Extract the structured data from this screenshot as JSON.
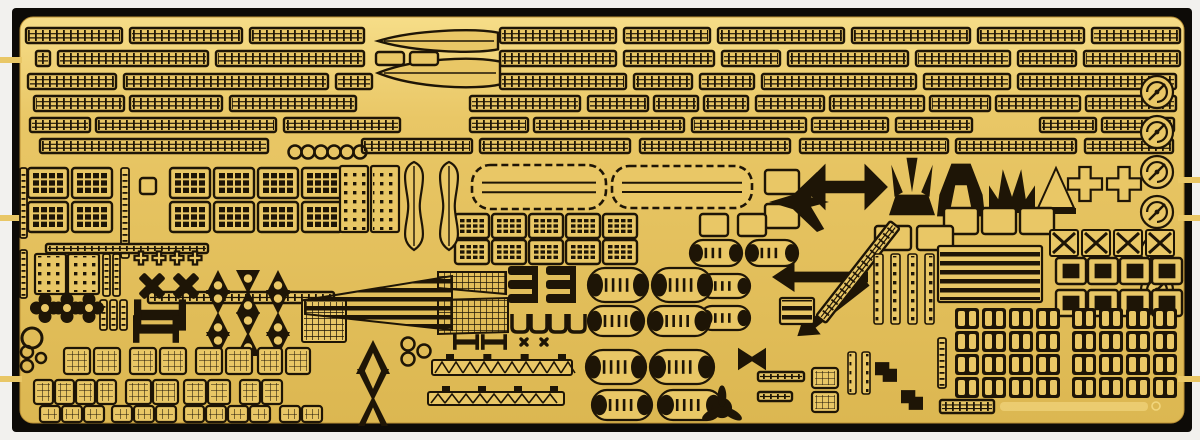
{
  "meta": {
    "alt": "Photograph of a gold photo-etched brass detail fret for a model ship kit, mounted on a black backing board, containing rows of railings, ladders, radar dishes, hatches, doors, life rafts, propeller guards and other small etched parts"
  },
  "colors": {
    "bg": "#f2f1ee",
    "backing": "#0d0b07",
    "brass": "#e9c766",
    "brass_hi": "#f6dd88",
    "brass_lo": "#dcb751",
    "etch": "#1e1506"
  },
  "frame": {
    "backing": {
      "x": 12,
      "y": 8,
      "w": 1180,
      "h": 424,
      "r": 4
    },
    "brass": {
      "x": 20,
      "y": 17,
      "w": 1164,
      "h": 406,
      "r": 13
    },
    "tabs": [
      {
        "x": 0,
        "y": 57,
        "w": 22,
        "h": 6
      },
      {
        "x": 0,
        "y": 215,
        "w": 22,
        "h": 6
      },
      {
        "x": 0,
        "y": 376,
        "w": 22,
        "h": 6
      },
      {
        "x": 1178,
        "y": 177,
        "w": 22,
        "h": 6
      },
      {
        "x": 1178,
        "y": 215,
        "w": 22,
        "h": 6
      },
      {
        "x": 1178,
        "y": 376,
        "w": 22,
        "h": 6
      }
    ],
    "faint_mark": {
      "x": 1000,
      "y": 402,
      "w": 148,
      "h": 9,
      "ring_x": 1156,
      "ring_y": 406
    }
  },
  "rail_rows": [
    {
      "y": 28,
      "h": 15,
      "segs": [
        [
          26,
          96
        ],
        [
          130,
          112
        ],
        [
          250,
          114
        ],
        [
          500,
          116
        ],
        [
          624,
          86
        ],
        [
          718,
          126
        ],
        [
          852,
          118
        ],
        [
          978,
          106
        ],
        [
          1092,
          88
        ]
      ]
    },
    {
      "y": 51,
      "h": 15,
      "segs": [
        [
          36,
          14
        ],
        [
          58,
          150
        ],
        [
          216,
          148
        ],
        [
          500,
          116
        ],
        [
          624,
          90
        ],
        [
          722,
          58
        ],
        [
          788,
          120
        ],
        [
          916,
          94
        ],
        [
          1018,
          58
        ],
        [
          1084,
          96
        ]
      ]
    },
    {
      "y": 74,
      "h": 15,
      "segs": [
        [
          28,
          88
        ],
        [
          124,
          204
        ],
        [
          336,
          36
        ],
        [
          500,
          126
        ],
        [
          634,
          58
        ],
        [
          700,
          54
        ],
        [
          762,
          154
        ],
        [
          924,
          86
        ],
        [
          1018,
          158
        ]
      ]
    },
    {
      "y": 96,
      "h": 15,
      "segs": [
        [
          34,
          90
        ],
        [
          130,
          92
        ],
        [
          230,
          126
        ],
        [
          470,
          110
        ],
        [
          588,
          60
        ],
        [
          654,
          44
        ],
        [
          704,
          44
        ],
        [
          756,
          68
        ],
        [
          830,
          94
        ],
        [
          930,
          60
        ],
        [
          996,
          84
        ],
        [
          1086,
          90
        ]
      ]
    },
    {
      "y": 118,
      "h": 14,
      "segs": [
        [
          30,
          60
        ],
        [
          96,
          180
        ],
        [
          284,
          116
        ],
        [
          470,
          58
        ],
        [
          534,
          150
        ],
        [
          692,
          114
        ],
        [
          812,
          76
        ],
        [
          896,
          76
        ],
        [
          1040,
          56
        ],
        [
          1102,
          72
        ]
      ]
    },
    {
      "y": 139,
      "h": 14,
      "segs": [
        [
          40,
          228
        ],
        [
          362,
          110
        ],
        [
          480,
          150
        ],
        [
          640,
          150
        ],
        [
          800,
          148
        ],
        [
          956,
          120
        ],
        [
          1085,
          88
        ]
      ]
    }
  ],
  "parts": [
    {
      "t": "spearH",
      "x": 378,
      "y": 30,
      "w": 120,
      "h": 22
    },
    {
      "t": "spearH",
      "x": 378,
      "y": 58,
      "w": 122,
      "h": 30
    },
    {
      "t": "frame",
      "x": 376,
      "y": 52,
      "w": 28,
      "h": 13
    },
    {
      "t": "frame",
      "x": 410,
      "y": 52,
      "w": 28,
      "h": 13
    },
    {
      "t": "ring",
      "cx": 295,
      "cy": 152,
      "r": 6.5,
      "sw": 2.5,
      "grid": {
        "nx": 6,
        "dx": 13
      }
    },
    {
      "t": "doorblock",
      "x": 28,
      "y": 168,
      "w": 40,
      "h": 30,
      "grid": {
        "nx": 2,
        "dx": 44,
        "ny": 2,
        "dy": 34
      }
    },
    {
      "t": "doorblock",
      "x": 170,
      "y": 168,
      "w": 40,
      "h": 30,
      "grid": {
        "nx": 4,
        "dx": 44,
        "ny": 2,
        "dy": 34
      }
    },
    {
      "t": "doorblock",
      "x": 455,
      "y": 214,
      "w": 34,
      "h": 24,
      "grid": {
        "nx": 5,
        "dx": 37,
        "ny": 2,
        "dy": 26
      }
    },
    {
      "t": "vlad",
      "x": 121,
      "y": 168,
      "w": 8,
      "h": 90
    },
    {
      "t": "vlad",
      "x": 20,
      "y": 168,
      "w": 7,
      "h": 70
    },
    {
      "t": "vlad",
      "x": 20,
      "y": 250,
      "w": 7,
      "h": 48
    },
    {
      "t": "vlad",
      "x": 103,
      "y": 254,
      "w": 7,
      "h": 42,
      "grid": {
        "nx": 2,
        "dx": 10
      }
    },
    {
      "t": "vlad",
      "x": 100,
      "y": 300,
      "w": 7,
      "h": 30,
      "grid": {
        "nx": 3,
        "dx": 10
      }
    },
    {
      "t": "frame",
      "x": 140,
      "y": 178,
      "w": 16,
      "h": 16
    },
    {
      "t": "dotp",
      "x": 340,
      "y": 166,
      "w": 28,
      "h": 66
    },
    {
      "t": "dotp",
      "x": 371,
      "y": 166,
      "w": 28,
      "h": 66
    },
    {
      "t": "dotp",
      "x": 35,
      "y": 254,
      "w": 31,
      "h": 40
    },
    {
      "t": "dotp",
      "x": 68,
      "y": 254,
      "w": 31,
      "h": 40
    },
    {
      "t": "bottle",
      "x": 398,
      "y": 162,
      "w": 32,
      "h": 88
    },
    {
      "t": "bottle",
      "x": 433,
      "y": 162,
      "w": 32,
      "h": 88
    },
    {
      "t": "deckp",
      "x": 472,
      "y": 165,
      "w": 134,
      "h": 44
    },
    {
      "t": "deckp",
      "x": 612,
      "y": 166,
      "w": 140,
      "h": 42
    },
    {
      "t": "frame",
      "x": 765,
      "y": 170,
      "w": 34,
      "h": 24
    },
    {
      "t": "frame",
      "x": 765,
      "y": 204,
      "w": 34,
      "h": 24
    },
    {
      "t": "organic",
      "v": "plane",
      "cx": 799,
      "cy": 202,
      "s": 60
    },
    {
      "t": "organic",
      "v": "anchor",
      "cx": 845,
      "cy": 187,
      "s": 78
    },
    {
      "t": "organic",
      "v": "tulip",
      "cx": 912,
      "cy": 190,
      "s": 46
    },
    {
      "t": "organic",
      "v": "bell",
      "cx": 961,
      "cy": 190,
      "s": 48
    },
    {
      "t": "organic",
      "v": "crown",
      "cx": 1012,
      "cy": 190,
      "s": 46
    },
    {
      "t": "organic",
      "v": "cone",
      "cx": 1056,
      "cy": 190,
      "s": 40
    },
    {
      "t": "plus",
      "cx": 1085,
      "cy": 184,
      "s": 34
    },
    {
      "t": "plus",
      "cx": 1124,
      "cy": 184,
      "s": 34
    },
    {
      "t": "radar",
      "cx": 1157,
      "cy": 92,
      "r": 16
    },
    {
      "t": "radar",
      "cx": 1157,
      "cy": 132,
      "r": 16
    },
    {
      "t": "radar",
      "cx": 1157,
      "cy": 172,
      "r": 16
    },
    {
      "t": "radar",
      "cx": 1157,
      "cy": 212,
      "r": 16
    },
    {
      "t": "radar",
      "cx": 1157,
      "cy": 252,
      "r": 16
    },
    {
      "t": "radar",
      "cx": 1157,
      "cy": 290,
      "r": 16
    },
    {
      "t": "frame",
      "x": 700,
      "y": 214,
      "w": 28,
      "h": 22,
      "grid": {
        "nx": 2,
        "dx": 38
      }
    },
    {
      "t": "frame",
      "x": 944,
      "y": 208,
      "w": 34,
      "h": 26,
      "grid": {
        "nx": 3,
        "dx": 38
      }
    },
    {
      "t": "frame",
      "x": 875,
      "y": 226,
      "w": 36,
      "h": 24,
      "grid": {
        "nx": 2,
        "dx": 42
      }
    },
    {
      "t": "xframe",
      "x": 1050,
      "y": 230,
      "w": 28,
      "h": 26,
      "grid": {
        "nx": 4,
        "dx": 32
      }
    },
    {
      "t": "frame",
      "x": 1056,
      "y": 258,
      "w": 30,
      "h": 26,
      "dark": true,
      "grid": {
        "nx": 4,
        "dx": 32,
        "ny": 2,
        "dy": 32
      }
    },
    {
      "t": "rail",
      "x": 46,
      "y": 244,
      "w": 162,
      "h": 9
    },
    {
      "t": "rail",
      "x": 148,
      "y": 292,
      "w": 186,
      "h": 11
    },
    {
      "t": "plus",
      "cx": 141,
      "cy": 258,
      "s": 13,
      "grid": {
        "nx": 4,
        "dx": 18
      }
    },
    {
      "t": "xcross",
      "cx": 152,
      "cy": 286,
      "s": 30
    },
    {
      "t": "xcross",
      "cx": 186,
      "cy": 286,
      "s": 30
    },
    {
      "t": "clover",
      "cx": 45,
      "cy": 308,
      "r": 9,
      "grid": {
        "nx": 3,
        "dx": 22
      }
    },
    {
      "t": "organic",
      "v": "dblT",
      "cx": 160,
      "cy": 315,
      "s": 52
    },
    {
      "t": "organic",
      "v": "dblT",
      "cx": 156,
      "cy": 329,
      "s": 46
    },
    {
      "t": "prop",
      "cx": 218,
      "cy": 282,
      "s": 24,
      "grid": {
        "nx": 3,
        "dx": 30,
        "ny": 2,
        "dy": 20
      }
    },
    {
      "t": "prop",
      "cx": 218,
      "cy": 324,
      "s": 24,
      "grid": {
        "nx": 3,
        "dx": 30,
        "ny": 2,
        "dy": 20
      }
    },
    {
      "t": "meshr",
      "x": 302,
      "y": 300,
      "w": 44,
      "h": 42
    },
    {
      "t": "poly",
      "fill": "stripes",
      "pts": [
        [
          305,
          300
        ],
        [
          452,
          276
        ],
        [
          452,
          330
        ],
        [
          305,
          314
        ]
      ]
    },
    {
      "t": "poly",
      "fill": "mesh",
      "pts": [
        [
          438,
          272
        ],
        [
          506,
          272
        ],
        [
          506,
          294
        ],
        [
          438,
          288
        ]
      ]
    },
    {
      "t": "poly",
      "fill": "mesh",
      "pts": [
        [
          438,
          300
        ],
        [
          508,
          298
        ],
        [
          508,
          332
        ],
        [
          438,
          334
        ]
      ]
    },
    {
      "t": "estack",
      "x": 508,
      "y": 266
    },
    {
      "t": "estack",
      "x": 546,
      "y": 266
    },
    {
      "t": "ucup",
      "x": 512,
      "y": 314,
      "w": 16,
      "h": 18,
      "grid": {
        "nx": 4,
        "dx": 19
      }
    },
    {
      "t": "float",
      "x": 690,
      "y": 240,
      "w": 52,
      "h": 26
    },
    {
      "t": "float",
      "x": 746,
      "y": 240,
      "w": 52,
      "h": 26
    },
    {
      "t": "float",
      "x": 700,
      "y": 274,
      "w": 50,
      "h": 24
    },
    {
      "t": "float",
      "x": 700,
      "y": 306,
      "w": 50,
      "h": 24
    },
    {
      "t": "float",
      "x": 588,
      "y": 268,
      "w": 60,
      "h": 34
    },
    {
      "t": "float",
      "x": 652,
      "y": 268,
      "w": 60,
      "h": 34
    },
    {
      "t": "float",
      "x": 588,
      "y": 306,
      "w": 56,
      "h": 30
    },
    {
      "t": "float",
      "x": 648,
      "y": 306,
      "w": 62,
      "h": 30
    },
    {
      "t": "float",
      "x": 586,
      "y": 350,
      "w": 60,
      "h": 34
    },
    {
      "t": "float",
      "x": 650,
      "y": 350,
      "w": 64,
      "h": 34
    },
    {
      "t": "float",
      "x": 592,
      "y": 390,
      "w": 60,
      "h": 30
    },
    {
      "t": "float",
      "x": 658,
      "y": 390,
      "w": 64,
      "h": 30
    },
    {
      "t": "arrowL",
      "x": 772,
      "y": 262,
      "w": 96,
      "h": 30
    },
    {
      "t": "arrowL",
      "x": 788,
      "y": 296,
      "w": 88,
      "h": 26,
      "angle": -38
    },
    {
      "t": "railrot",
      "x": 798,
      "y": 266,
      "w": 120,
      "h": 12,
      "angle": -52
    },
    {
      "t": "dstrip",
      "x": 874,
      "y": 254,
      "w": 9,
      "h": 70,
      "grid": {
        "nx": 4,
        "dx": 17
      }
    },
    {
      "t": "dstrip",
      "x": 848,
      "y": 352,
      "w": 8,
      "h": 42,
      "grid": {
        "nx": 2,
        "dx": 14
      }
    },
    {
      "t": "stripr",
      "x": 938,
      "y": 246,
      "w": 104,
      "h": 56
    },
    {
      "t": "stripr",
      "x": 780,
      "y": 298,
      "w": 34,
      "h": 26
    },
    {
      "t": "vlad",
      "x": 938,
      "y": 338,
      "w": 8,
      "h": 50
    },
    {
      "t": "pairdoor",
      "x": 955,
      "y": 308,
      "w": 24,
      "h": 21,
      "grid": {
        "nx": 4,
        "dx": 27,
        "ny": 4,
        "dy": 23
      }
    },
    {
      "t": "pairdoor",
      "x": 1072,
      "y": 308,
      "w": 24,
      "h": 21,
      "grid": {
        "nx": 4,
        "dx": 27,
        "ny": 4,
        "dy": 23
      }
    },
    {
      "t": "ring",
      "cx": 32,
      "cy": 338,
      "r": 10,
      "sw": 3
    },
    {
      "t": "ring",
      "cx": 27,
      "cy": 352,
      "r": 6,
      "sw": 2.5
    },
    {
      "t": "ring",
      "cx": 27,
      "cy": 366,
      "r": 6,
      "sw": 2.5
    },
    {
      "t": "ring",
      "cx": 41,
      "cy": 358,
      "r": 5,
      "sw": 2.5
    },
    {
      "t": "hatch",
      "x": 64,
      "y": 348,
      "w": 26,
      "h": 26,
      "grid": {
        "nx": 2,
        "dx": 30
      }
    },
    {
      "t": "hatch",
      "x": 130,
      "y": 348,
      "w": 26,
      "h": 26,
      "grid": {
        "nx": 2,
        "dx": 30
      }
    },
    {
      "t": "hatch",
      "x": 196,
      "y": 348,
      "w": 26,
      "h": 26,
      "grid": {
        "nx": 2,
        "dx": 30
      }
    },
    {
      "t": "hatch",
      "x": 258,
      "y": 348,
      "w": 24,
      "h": 26,
      "grid": {
        "nx": 2,
        "dx": 28
      }
    },
    {
      "t": "hatch",
      "x": 34,
      "y": 380,
      "w": 19,
      "h": 24,
      "grid": {
        "nx": 4,
        "dx": 21
      }
    },
    {
      "t": "hatch",
      "x": 126,
      "y": 380,
      "w": 25,
      "h": 24,
      "grid": {
        "nx": 2,
        "dx": 27
      }
    },
    {
      "t": "hatch",
      "x": 184,
      "y": 380,
      "w": 22,
      "h": 24,
      "grid": {
        "nx": 2,
        "dx": 24
      }
    },
    {
      "t": "hatch",
      "x": 240,
      "y": 380,
      "w": 20,
      "h": 24,
      "grid": {
        "nx": 2,
        "dx": 22
      }
    },
    {
      "t": "hatch",
      "x": 40,
      "y": 406,
      "w": 20,
      "h": 16,
      "grid": {
        "nx": 3,
        "dx": 22
      }
    },
    {
      "t": "hatch",
      "x": 112,
      "y": 406,
      "w": 20,
      "h": 16,
      "grid": {
        "nx": 3,
        "dx": 22
      }
    },
    {
      "t": "hatch",
      "x": 184,
      "y": 406,
      "w": 20,
      "h": 16,
      "grid": {
        "nx": 4,
        "dx": 22
      }
    },
    {
      "t": "hatch",
      "x": 280,
      "y": 406,
      "w": 20,
      "h": 16,
      "grid": {
        "nx": 2,
        "dx": 22
      }
    },
    {
      "t": "organic",
      "v": "chevUp",
      "cx": 373,
      "cy": 357,
      "s": 34
    },
    {
      "t": "organic",
      "v": "chevDown",
      "cx": 373,
      "cy": 385,
      "s": 32
    },
    {
      "t": "organic",
      "v": "chevUp",
      "cx": 373,
      "cy": 411,
      "s": 30
    },
    {
      "t": "ring",
      "cx": 408,
      "cy": 344,
      "r": 6.5,
      "sw": 2.5
    },
    {
      "t": "ring",
      "cx": 408,
      "cy": 359,
      "r": 6.5,
      "sw": 2.5
    },
    {
      "t": "ring",
      "cx": 424,
      "cy": 351,
      "r": 6.5,
      "sw": 2.5
    },
    {
      "t": "organic",
      "v": "dblT",
      "cx": 466,
      "cy": 342,
      "s": 26
    },
    {
      "t": "organic",
      "v": "dblT",
      "cx": 494,
      "cy": 342,
      "s": 26
    },
    {
      "t": "xcross",
      "cx": 524,
      "cy": 342,
      "s": 12
    },
    {
      "t": "xcross",
      "cx": 544,
      "cy": 342,
      "s": 12
    },
    {
      "t": "trussbar",
      "x": 432,
      "y": 360,
      "w": 140,
      "h": 15
    },
    {
      "t": "trussbar",
      "x": 428,
      "y": 392,
      "w": 136,
      "h": 13
    },
    {
      "t": "organic",
      "v": "bowtie",
      "cx": 752,
      "cy": 359,
      "s": 28
    },
    {
      "t": "organic",
      "v": "darkprop",
      "cx": 722,
      "cy": 408,
      "s": 36
    },
    {
      "t": "rail",
      "x": 758,
      "y": 372,
      "w": 46,
      "h": 9
    },
    {
      "t": "rail",
      "x": 758,
      "y": 392,
      "w": 34,
      "h": 9
    },
    {
      "t": "hatch",
      "x": 812,
      "y": 368,
      "w": 26,
      "h": 20
    },
    {
      "t": "hatch",
      "x": 812,
      "y": 392,
      "w": 26,
      "h": 20
    },
    {
      "t": "organic",
      "v": "zpiece",
      "cx": 886,
      "cy": 372,
      "s": 22
    },
    {
      "t": "organic",
      "v": "zpiece",
      "cx": 912,
      "cy": 400,
      "s": 22
    },
    {
      "t": "rail",
      "x": 940,
      "y": 400,
      "w": 54,
      "h": 13
    }
  ]
}
